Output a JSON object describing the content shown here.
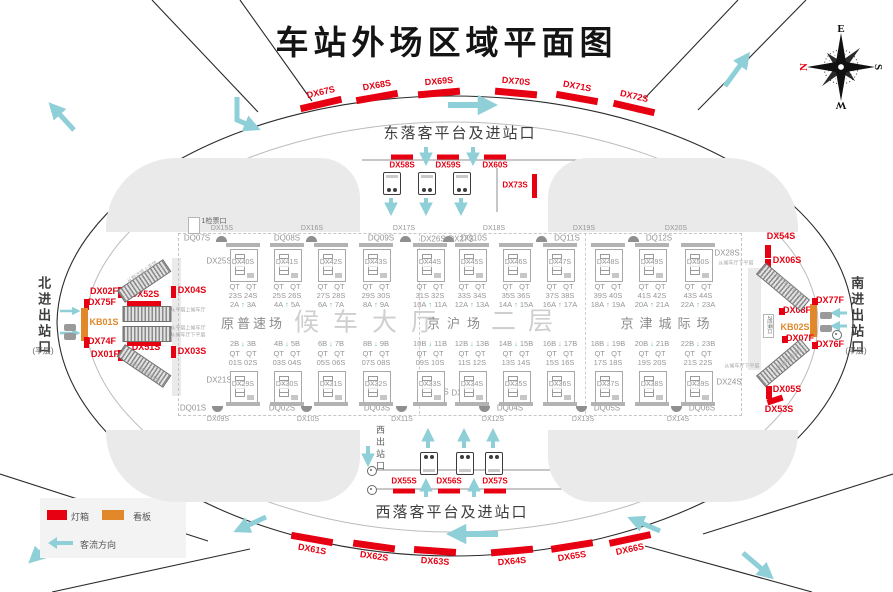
{
  "title": "车站外场区域平面图",
  "colors": {
    "red": "#e60012",
    "orange": "#e0882a",
    "teal": "#8ecfd8",
    "building_gray": "#eaeaea"
  },
  "compass": {
    "points": [
      {
        "t": "E",
        "x": 841,
        "y": 29,
        "r": 0,
        "red": false
      },
      {
        "t": "S",
        "x": 878,
        "y": 67,
        "r": 90,
        "red": false
      },
      {
        "t": "W",
        "x": 841,
        "y": 105,
        "r": 180,
        "red": false
      },
      {
        "t": "N",
        "x": 804,
        "y": 67,
        "r": -90,
        "red": true
      }
    ]
  },
  "legend": {
    "lightbox_label": "灯箱",
    "board_label": "看板",
    "flow_label": "客流方向"
  },
  "perimeter_signs": {
    "top": [
      {
        "id": "DX67S",
        "x": 321,
        "y": 104,
        "r": -13
      },
      {
        "id": "DX68S",
        "x": 377,
        "y": 97,
        "r": -10
      },
      {
        "id": "DX69S",
        "x": 439,
        "y": 93,
        "r": -5
      },
      {
        "id": "DX70S",
        "x": 516,
        "y": 93,
        "r": 5
      },
      {
        "id": "DX71S",
        "x": 577,
        "y": 98,
        "r": 10
      },
      {
        "id": "DX72S",
        "x": 634,
        "y": 108,
        "r": 13
      }
    ],
    "bottom": [
      {
        "id": "DX61S",
        "x": 312,
        "y": 539,
        "r": 10
      },
      {
        "id": "DX62S",
        "x": 374,
        "y": 546,
        "r": 8
      },
      {
        "id": "DX63S",
        "x": 435,
        "y": 551,
        "r": 4
      },
      {
        "id": "DX64S",
        "x": 512,
        "y": 551,
        "r": -5
      },
      {
        "id": "DX65S",
        "x": 572,
        "y": 546,
        "r": -9
      },
      {
        "id": "DX66S",
        "x": 630,
        "y": 539,
        "r": -12
      }
    ]
  },
  "east_platform": {
    "title": "东落客平台及进站口",
    "title_x": 460,
    "title_y": 134,
    "signs": [
      {
        "id": "DX58S",
        "x": 402
      },
      {
        "id": "DX59S",
        "x": 448
      },
      {
        "id": "DX60S",
        "x": 495
      }
    ],
    "side_sign": {
      "id": "DX73S",
      "bar": [
        532,
        174,
        5,
        24
      ],
      "lx": 515,
      "ly": 186
    }
  },
  "west_platform": {
    "title": "西落客平台及进站口",
    "title_x": 452,
    "title_y": 513,
    "exit_label": "西出站口",
    "signs": [
      {
        "id": "DX55S",
        "x": 404
      },
      {
        "id": "DX56S",
        "x": 449
      },
      {
        "id": "DX57S",
        "x": 495
      }
    ]
  },
  "north_entrance": {
    "label": "北进出站口",
    "floor_note": "(平层)",
    "signs": [
      {
        "id": "DX02F",
        "bar": [
          118,
          287,
          5,
          11
        ],
        "lx": 104,
        "ly": 292
      },
      {
        "id": "DX75F",
        "bar": [
          84,
          299,
          5,
          11
        ],
        "lx": 102,
        "ly": 303
      },
      {
        "id": "KB01S",
        "bar": [
          81,
          308,
          7,
          33
        ],
        "lx": 104,
        "ly": 323,
        "kind": "board"
      },
      {
        "id": "DX74F",
        "bar": [
          84,
          337,
          5,
          11
        ],
        "lx": 102,
        "ly": 342
      },
      {
        "id": "DX01F",
        "bar": [
          118,
          350,
          5,
          11
        ],
        "lx": 105,
        "ly": 355
      },
      {
        "id": "DX52S",
        "bar": [
          127,
          301,
          34,
          6
        ],
        "lx": 145,
        "ly": 295
      },
      {
        "id": "DX51S",
        "bar": [
          127,
          340,
          34,
          6
        ],
        "lx": 146,
        "ly": 348
      },
      {
        "id": "DX04S",
        "bar": [
          171,
          286,
          5,
          12
        ],
        "lx": 192,
        "ly": 291
      },
      {
        "id": "DX03S",
        "bar": [
          171,
          346,
          5,
          12
        ],
        "lx": 192,
        "ly": 352
      }
    ]
  },
  "south_entrance": {
    "label": "南进出站口",
    "floor_note": "(平层)",
    "checkpoint_label": "2检票口",
    "signs": [
      {
        "id": "DX54S",
        "bar": [
          765,
          245,
          6,
          13
        ],
        "lx": 781,
        "ly": 237
      },
      {
        "id": "DX06S",
        "bar": [
          765,
          259,
          6,
          12
        ],
        "lx": 787,
        "ly": 261
      },
      {
        "id": "DX08F",
        "bar": [
          779,
          308,
          6,
          7
        ],
        "lx": 797,
        "ly": 311
      },
      {
        "id": "KB02S",
        "bar": [
          810,
          304,
          7,
          33
        ],
        "lx": 795,
        "ly": 328,
        "kind": "board"
      },
      {
        "id": "DX77F",
        "bar": [
          812,
          298,
          6,
          7
        ],
        "lx": 830,
        "ly": 301
      },
      {
        "id": "DX07F",
        "bar": [
          782,
          336,
          6,
          7
        ],
        "lx": 800,
        "ly": 339
      },
      {
        "id": "DX76F",
        "bar": [
          812,
          342,
          6,
          7
        ],
        "lx": 830,
        "ly": 345
      },
      {
        "id": "DX05S",
        "bar": [
          766,
          386,
          6,
          13
        ],
        "lx": 787,
        "ly": 390
      },
      {
        "id": "DX53S",
        "bar": [
          767,
          397,
          16,
          6
        ],
        "rot": -18,
        "lx": 779,
        "ly": 410
      }
    ]
  },
  "hall": {
    "checkpoint_label": "1检票口",
    "top_dx": {
      "labels": [
        "DX15S",
        "DX16S",
        "DX17S",
        "DX18S",
        "DX19S",
        "DX20S"
      ],
      "xs": [
        222,
        312,
        404,
        494,
        584,
        676
      ],
      "y": 229
    },
    "top_dq": {
      "labels": [
        "DQ07S",
        "DQ08S",
        "DQ09S",
        "DQ10S",
        "DQ11S",
        "DQ12S"
      ],
      "xs": [
        197,
        287,
        381,
        474,
        567,
        659
      ],
      "y": 239,
      "icon_side": [
        "r",
        "r",
        "r",
        "l",
        "l",
        "l"
      ]
    },
    "bottom_dq": {
      "labels": [
        "DQ01S",
        "DQ02S",
        "DQ03S",
        "DQ04S",
        "DQ05S",
        "DQ06S"
      ],
      "xs": [
        193,
        282,
        377,
        510,
        607,
        702
      ],
      "y": 409,
      "icon_side": [
        "r",
        "r",
        "r",
        "l",
        "l",
        "l"
      ]
    },
    "bottom_dx": {
      "labels": [
        "DX09S",
        "DX10S",
        "DX11S",
        "DX12S",
        "DX13S",
        "DX14S"
      ],
      "xs": [
        218,
        308,
        402,
        493,
        583,
        678
      ],
      "y": 420
    },
    "corners": [
      {
        "id": "DX25S",
        "x": 219,
        "y": 262
      },
      {
        "id": "DX26S",
        "x": 433,
        "y": 240
      },
      {
        "id": "DX27S",
        "x": 461,
        "y": 240
      },
      {
        "id": "DX28S",
        "x": 727,
        "y": 254
      },
      {
        "id": "DX21S",
        "x": 219,
        "y": 381
      },
      {
        "id": "DX22S",
        "x": 436,
        "y": 393
      },
      {
        "id": "DX23S",
        "x": 464,
        "y": 394
      },
      {
        "id": "DX24S",
        "x": 729,
        "y": 383
      }
    ],
    "zones": [
      {
        "name": "原普速场",
        "x": 253,
        "y": 324,
        "cls": "zone-s",
        "ls": 3
      },
      {
        "name": "候车大厅",
        "x": 372,
        "y": 323,
        "cls": "zone-l",
        "ls": 14
      },
      {
        "name": "京沪场",
        "x": 457,
        "y": 324,
        "cls": "zone-s",
        "ls": 7
      },
      {
        "name": "二层",
        "x": 528,
        "y": 322,
        "cls": "zone-l",
        "ls": 12
      },
      {
        "name": "京津城际场",
        "x": 668,
        "y": 324,
        "cls": "zone-s",
        "ls": 6
      }
    ],
    "gate_prefix": "QT",
    "bay_xs": [
      243,
      287,
      331,
      376,
      430,
      472,
      516,
      560,
      608,
      652,
      698
    ],
    "upper_bays": [
      {
        "box": "DX40S",
        "gates": [
          "23S",
          "24S"
        ],
        "doors": [
          "2A",
          "3A"
        ]
      },
      {
        "box": "DX41S",
        "gates": [
          "25S",
          "26S"
        ],
        "doors": [
          "4A",
          "5A"
        ]
      },
      {
        "box": "DX42S",
        "gates": [
          "27S",
          "28S"
        ],
        "doors": [
          "6A",
          "7A"
        ]
      },
      {
        "box": "DX43S",
        "gates": [
          "29S",
          "30S"
        ],
        "doors": [
          "8A",
          "9A"
        ]
      },
      {
        "box": "DX44S",
        "gates": [
          "31S",
          "32S"
        ],
        "doors": [
          "10A",
          "11A"
        ]
      },
      {
        "box": "DX45S",
        "gates": [
          "33S",
          "34S"
        ],
        "doors": [
          "12A",
          "13A"
        ]
      },
      {
        "box": "DX46S",
        "gates": [
          "35S",
          "36S"
        ],
        "doors": [
          "14A",
          "15A"
        ]
      },
      {
        "box": "DX47S",
        "gates": [
          "37S",
          "38S"
        ],
        "doors": [
          "16A",
          "17A"
        ]
      },
      {
        "box": "DX48S",
        "gates": [
          "39S",
          "40S"
        ],
        "doors": [
          "18A",
          "19A"
        ]
      },
      {
        "box": "DX49S",
        "gates": [
          "41S",
          "42S"
        ],
        "doors": [
          "20A",
          "21A"
        ]
      },
      {
        "box": "DX50S",
        "gates": [
          "43S",
          "44S"
        ],
        "doors": [
          "22A",
          "23A"
        ]
      }
    ],
    "lower_bays": [
      {
        "box": "DX29S",
        "gates": [
          "01S",
          "02S"
        ],
        "doors": [
          "2B",
          "3B"
        ]
      },
      {
        "box": "DX30S",
        "gates": [
          "03S",
          "04S"
        ],
        "doors": [
          "4B",
          "5B"
        ]
      },
      {
        "box": "DX31S",
        "gates": [
          "05S",
          "06S"
        ],
        "doors": [
          "6B",
          "7B"
        ]
      },
      {
        "box": "DX32S",
        "gates": [
          "07S",
          "08S"
        ],
        "doors": [
          "8B",
          "9B"
        ]
      },
      {
        "box": "DX33S",
        "gates": [
          "09S",
          "10S"
        ],
        "doors": [
          "10B",
          "11B"
        ]
      },
      {
        "box": "DX34S",
        "gates": [
          "11S",
          "12S"
        ],
        "doors": [
          "12B",
          "13B"
        ]
      },
      {
        "box": "DX35S",
        "gates": [
          "13S",
          "14S"
        ],
        "doors": [
          "14B",
          "15B"
        ]
      },
      {
        "box": "DX36S",
        "gates": [
          "15S",
          "16S"
        ],
        "doors": [
          "16B",
          "17B"
        ]
      },
      {
        "box": "DX37S",
        "gates": [
          "17S",
          "18S"
        ],
        "doors": [
          "18B",
          "19B"
        ]
      },
      {
        "box": "DX38S",
        "gates": [
          "19S",
          "20S"
        ],
        "doors": [
          "20B",
          "21B"
        ]
      },
      {
        "box": "DX39S",
        "gates": [
          "21S",
          "22S"
        ],
        "doors": [
          "22B",
          "23B"
        ]
      }
    ],
    "escalator_notes": {
      "up_to_hall": "从平层上候车厅",
      "down_from_hall": "从候车厅下平层",
      "up_from_arrival": "从到达层上平层",
      "down_to_arrival": "从平层下到达层"
    }
  }
}
